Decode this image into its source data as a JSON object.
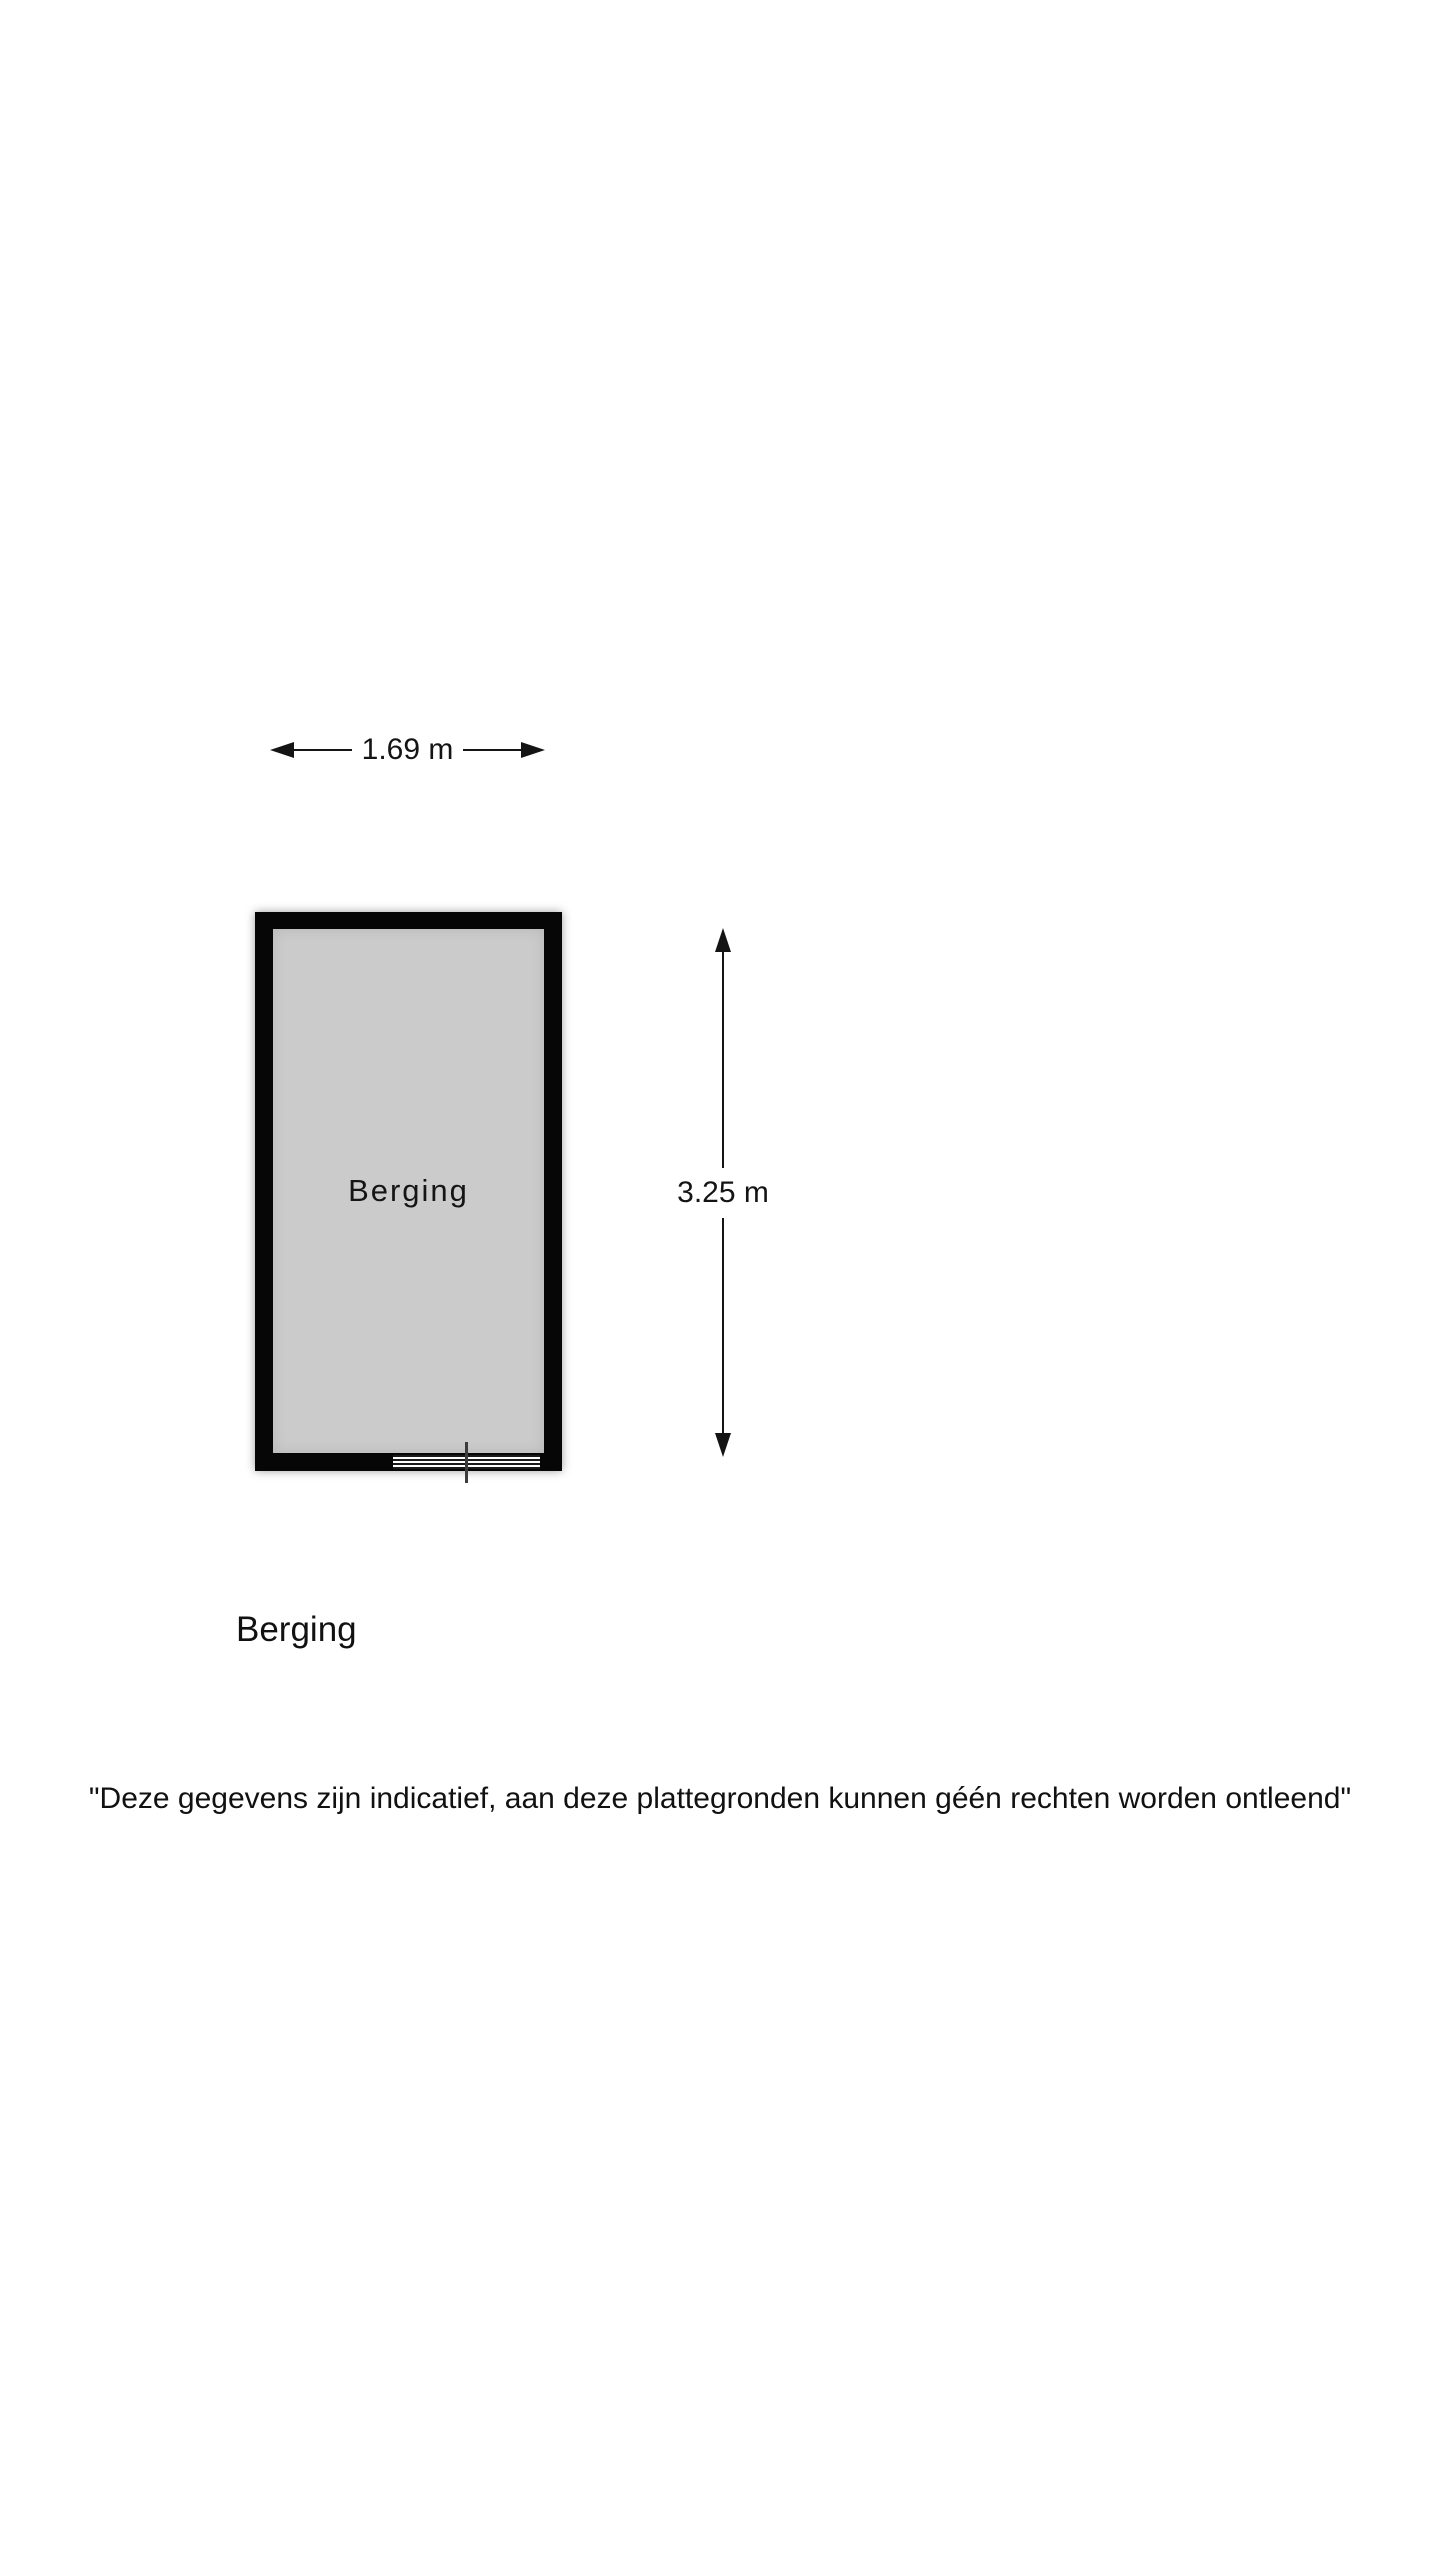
{
  "floorplan": {
    "room": {
      "label": "Berging",
      "floor_color": "#cbcbcb",
      "wall_color": "#060606"
    },
    "dimensions": {
      "width_label": "1.69 m",
      "height_label": "3.25 m"
    },
    "icons": {
      "arrow_left": "arrow-left-icon",
      "arrow_right": "arrow-right-icon",
      "arrow_up": "arrow-up-icon",
      "arrow_down": "arrow-down-icon"
    },
    "caption": "Berging",
    "disclaimer": "\"Deze gegevens zijn indicatief, aan deze plattegronden kunnen géén rechten worden ontleend\""
  }
}
